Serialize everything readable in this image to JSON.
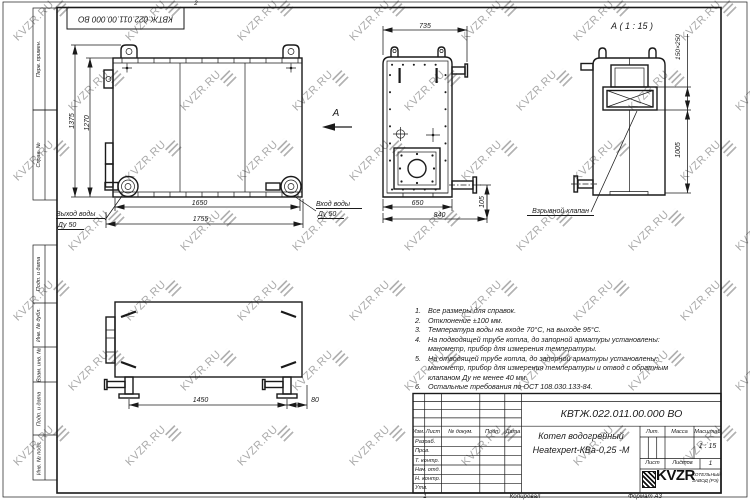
{
  "watermark": {
    "text": "KVZR.RU"
  },
  "frame": {
    "top_stamp": "КВТЖ.022.011.00.000 ВО",
    "zone_mark": "2",
    "side_labels": {
      "perv": "Перв. примен.",
      "sprav": "Справ. №",
      "podp1": "Подп. и дата",
      "inv_dubl": "Инв. № дубл.",
      "vzam": "Взам. инв. №",
      "podp2": "Подп. и дата",
      "inv_podl": "Инв. № подл."
    },
    "bottom": {
      "copy_num": "1",
      "copied": "Копировал",
      "format": "Формат А3"
    }
  },
  "dims": {
    "front_width": "735",
    "side_h1": "1375",
    "side_h2": "1270",
    "side_w1": "1650",
    "side_w2": "1755",
    "front_w1": "650",
    "front_w2": "840",
    "front_h": "105",
    "valve_size": "150×250",
    "detail_h": "1005",
    "plan_w": "1450",
    "plan_off": "80"
  },
  "labels": {
    "detail_title": "А ( 1 : 15 )",
    "view_arrow": "А",
    "outlet_line1": "Выход воды",
    "outlet_line2": "Ду 50",
    "inlet_line1": "Вход воды",
    "inlet_line2": "Ду 50",
    "valve": "Взрывной клапан"
  },
  "notes": [
    {
      "num": "1.",
      "l1": "Все размеры для справок."
    },
    {
      "num": "2.",
      "l1": "Отклонение ±100 мм."
    },
    {
      "num": "3.",
      "l1": "Температура воды на входе 70°С, на выходе 95°С."
    },
    {
      "num": "4.",
      "l1": "На подводящей трубе котла, до запорной арматуры установлены:",
      "l2": "манометр, прибор для измерения температуры."
    },
    {
      "num": "5.",
      "l1": "На отводящей трубе котла, до запорной арматуры установлены:",
      "l2": "манометр, прибор для измерения температуры и отвод с обратным",
      "l3": "клапаном Ду не менее 40 мм."
    },
    {
      "num": "6.",
      "l1": "Остальные требования по ОСТ 108.030.133-84."
    }
  ],
  "title_block": {
    "doc_number": "КВТЖ.022.011.00.000 ВО",
    "product_line1": "Котел водогрейный",
    "product_line2": "Heatexpert-КВа-0,25 -М",
    "col_izm": "Изм.",
    "col_list": "Лист",
    "col_doc": "№ докум.",
    "col_podp": "Подп.",
    "col_data": "Дата",
    "row_razrab": "Разраб.",
    "row_prov": "Пров.",
    "row_tkontr": "Т. контр.",
    "row_nachotd": "Нач. отд.",
    "row_nkontr": "Н. контр.",
    "row_utv": "Утв.",
    "lit_label": "Лит.",
    "mass_label": "Масса",
    "scale_label": "Масштаб",
    "scale_value": "1 : 15",
    "list_label": "Лист",
    "listov_label": "Листов",
    "listov_value": "1",
    "logo": "KVZR",
    "logo_sub1": "КОТЕЛЬНЫЙ",
    "logo_sub2": "ЗАВОД (РЭ)"
  }
}
